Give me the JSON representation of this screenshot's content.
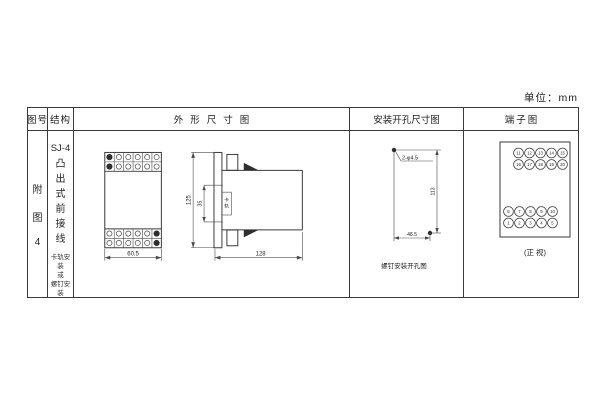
{
  "unit_label": "单位：mm",
  "table_headers": {
    "figure_no": "图号",
    "structure": "结构",
    "outline": "外形尺寸图",
    "mounting": "安装开孔尺寸图",
    "terminal": "端子图"
  },
  "figure_no": {
    "chars": [
      "附",
      "图",
      "4"
    ]
  },
  "structure": {
    "model": "SJ-4",
    "type_chars": [
      "凸",
      "出",
      "式",
      "前",
      "接",
      "线"
    ],
    "mount_note": [
      "卡轨安装",
      "或",
      "螺钉安装"
    ]
  },
  "outline": {
    "front_width": "60.5",
    "height": "125",
    "rail_dim": "35",
    "rail_chars": [
      "卡",
      "轨"
    ],
    "depth": "128"
  },
  "mounting": {
    "holes": "2-φ4.5",
    "v_dim": "113",
    "h_dim": "48.5",
    "caption": "螺钉安装开孔图"
  },
  "terminal": {
    "caption": "(正 视)",
    "top_rows": [
      [
        "11",
        "12",
        "13",
        "14",
        "15"
      ],
      [
        "16",
        "17",
        "18",
        "19",
        "20"
      ]
    ],
    "bottom_rows": [
      [
        "6",
        "7",
        "8",
        "9",
        "10"
      ],
      [
        "1",
        "2",
        "3",
        "4",
        "5"
      ]
    ]
  },
  "colors": {
    "line": "#3a3a3a",
    "text": "#222222",
    "background": "#ffffff"
  }
}
